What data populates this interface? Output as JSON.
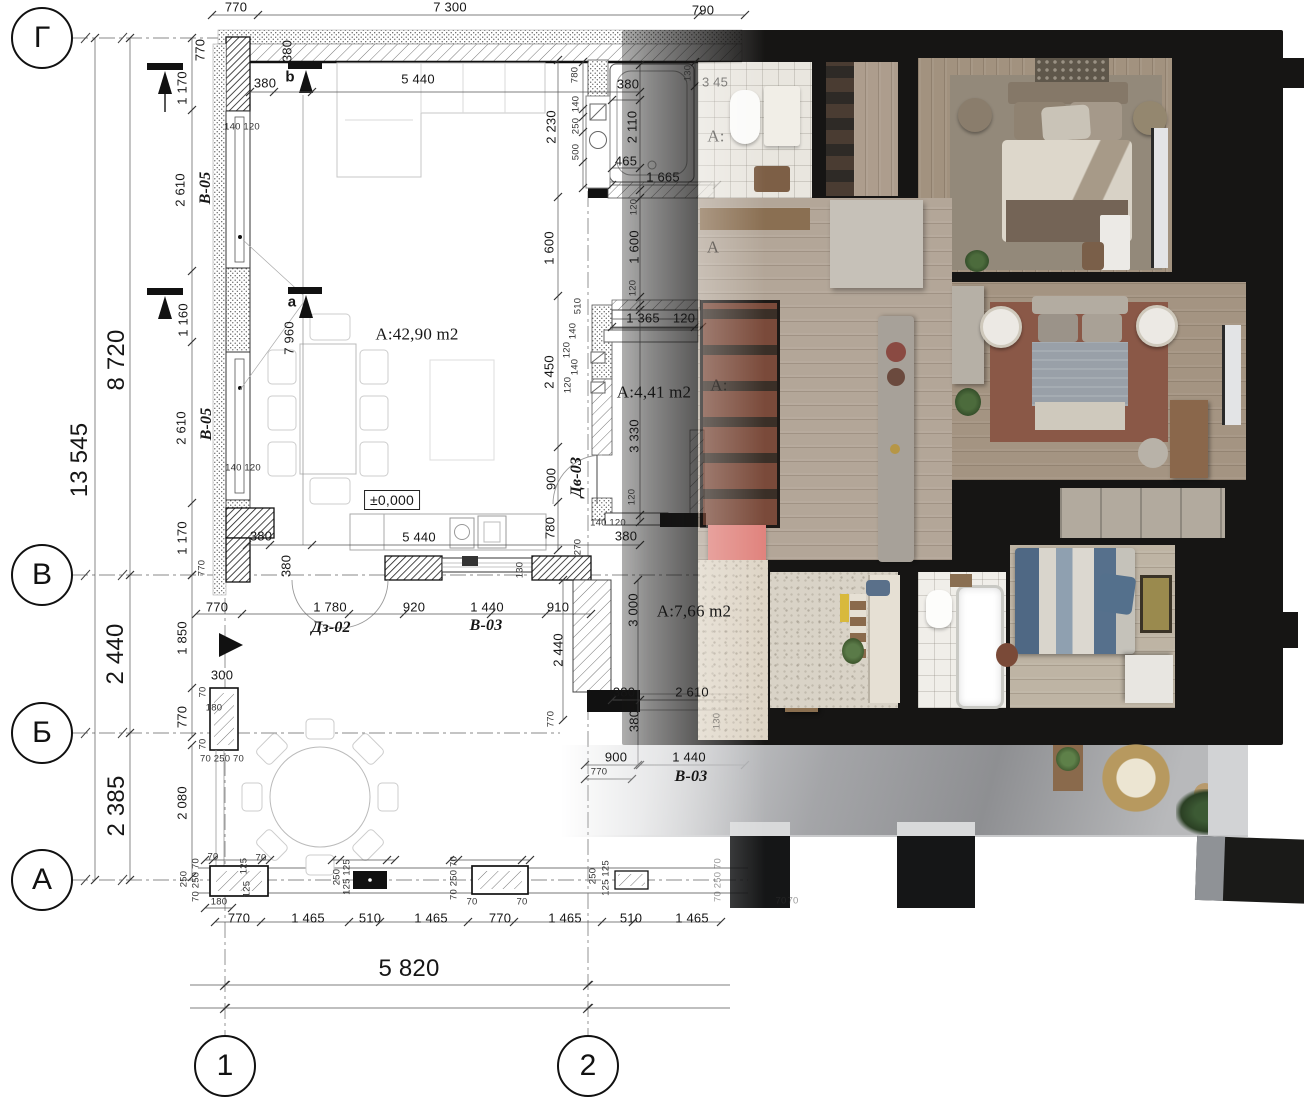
{
  "axes": {
    "row_bubbles": [
      "Г",
      "В",
      "Б",
      "А"
    ],
    "column_bubbles": [
      "1",
      "2"
    ]
  },
  "room_areas": [
    "A:42,90 m2",
    "А:4,41 m2",
    "A:7,66 m2"
  ],
  "level_mark": "±0,000",
  "window_tags": [
    "В-05",
    "В-03"
  ],
  "door_tags": [
    "Дз-02",
    "Дв-03"
  ],
  "overall_dimensions": {
    "left_total": "13 545",
    "left_upper": "8 720",
    "top_total": "7 300",
    "bottom_span": "5 820"
  },
  "colors": {
    "wall_render": "#161514",
    "wood_floor": "#ab9c8b",
    "rug_warm": "#8a5847",
    "rug_neutral": "#93897a",
    "bed_blue": "#54708c",
    "terrace_concrete": "#a4a5a8",
    "accent_bench": "#e0837d",
    "line_dark": "#1a1a1a"
  },
  "grid_bubbles": [
    {
      "t": "Г",
      "x": 42,
      "y": 38
    },
    {
      "t": "В",
      "x": 42,
      "y": 575
    },
    {
      "t": "Б",
      "x": 42,
      "y": 733
    },
    {
      "t": "А",
      "x": 42,
      "y": 880
    },
    {
      "t": "1",
      "x": 225,
      "y": 1066
    },
    {
      "t": "2",
      "x": 588,
      "y": 1066
    }
  ],
  "labels": [
    {
      "t": "770",
      "x": 236,
      "y": 7
    },
    {
      "t": "7 300",
      "x": 450,
      "y": 7
    },
    {
      "t": "790",
      "x": 703,
      "y": 10
    },
    {
      "t": "770",
      "x": 200,
      "y": 50,
      "c": "v"
    },
    {
      "t": "380",
      "x": 287,
      "y": 51,
      "c": "v"
    },
    {
      "t": "380",
      "x": 265,
      "y": 83
    },
    {
      "t": "b",
      "x": 290,
      "y": 77,
      "c": "bold"
    },
    {
      "t": "5 440",
      "x": 418,
      "y": 79
    },
    {
      "t": "1 170",
      "x": 182,
      "y": 88,
      "c": "v"
    },
    {
      "t": "140 120",
      "x": 242,
      "y": 127,
      "c": "s"
    },
    {
      "t": "2 610",
      "x": 180,
      "y": 190,
      "c": "v"
    },
    {
      "t": "В-05",
      "x": 206,
      "y": 188,
      "c": "v bi"
    },
    {
      "t": "1 160",
      "x": 183,
      "y": 320,
      "c": "v"
    },
    {
      "t": "2 610",
      "x": 181,
      "y": 428,
      "c": "v"
    },
    {
      "t": "В-05",
      "x": 207,
      "y": 424,
      "c": "v bi"
    },
    {
      "t": "140 120",
      "x": 243,
      "y": 468,
      "c": "s"
    },
    {
      "t": "1 170",
      "x": 182,
      "y": 538,
      "c": "v"
    },
    {
      "t": "770",
      "x": 202,
      "y": 568,
      "c": "v s"
    },
    {
      "t": "8 720",
      "x": 117,
      "y": 360,
      "c": "v big"
    },
    {
      "t": "13 545",
      "x": 80,
      "y": 460,
      "c": "v big"
    },
    {
      "t": "a",
      "x": 292,
      "y": 302,
      "c": "bold"
    },
    {
      "t": "7 960",
      "x": 289,
      "y": 338,
      "c": "v"
    },
    {
      "t": "A:42,90 m2",
      "x": 417,
      "y": 334,
      "c": "area"
    },
    {
      "t": "±0,000",
      "x": 392,
      "y": 500,
      "c": "boxed"
    },
    {
      "t": "5 440",
      "x": 419,
      "y": 537
    },
    {
      "t": "380",
      "x": 261,
      "y": 536
    },
    {
      "t": "380",
      "x": 286,
      "y": 566,
      "c": "v"
    },
    {
      "t": "770",
      "x": 217,
      "y": 607
    },
    {
      "t": "1 780",
      "x": 330,
      "y": 607
    },
    {
      "t": "920",
      "x": 414,
      "y": 607
    },
    {
      "t": "1 440",
      "x": 487,
      "y": 607
    },
    {
      "t": "910",
      "x": 558,
      "y": 607
    },
    {
      "t": "Дз-02",
      "x": 331,
      "y": 628,
      "c": "bi"
    },
    {
      "t": "В-03",
      "x": 486,
      "y": 626,
      "c": "bi"
    },
    {
      "t": "1 850",
      "x": 182,
      "y": 638,
      "c": "v"
    },
    {
      "t": "300",
      "x": 222,
      "y": 675
    },
    {
      "t": "180",
      "x": 214,
      "y": 708,
      "c": "s"
    },
    {
      "t": "770",
      "x": 182,
      "y": 717,
      "c": "v"
    },
    {
      "t": "70",
      "x": 203,
      "y": 692,
      "c": "v s"
    },
    {
      "t": "70",
      "x": 203,
      "y": 744,
      "c": "v s"
    },
    {
      "t": "70 250 70",
      "x": 222,
      "y": 759,
      "c": "s"
    },
    {
      "t": "2 440",
      "x": 116,
      "y": 654,
      "c": "v big"
    },
    {
      "t": "2 385",
      "x": 117,
      "y": 806,
      "c": "v big"
    },
    {
      "t": "2 080",
      "x": 182,
      "y": 803,
      "c": "v"
    },
    {
      "t": "250",
      "x": 184,
      "y": 879,
      "c": "v s"
    },
    {
      "t": "70 250 70",
      "x": 196,
      "y": 880,
      "c": "v s"
    },
    {
      "t": "70",
      "x": 213,
      "y": 857,
      "c": "s"
    },
    {
      "t": "70",
      "x": 261,
      "y": 858,
      "c": "s"
    },
    {
      "t": "125",
      "x": 244,
      "y": 866,
      "c": "v s"
    },
    {
      "t": "125",
      "x": 247,
      "y": 889,
      "c": "v s"
    },
    {
      "t": "180",
      "x": 219,
      "y": 902,
      "c": "s"
    },
    {
      "t": "770",
      "x": 239,
      "y": 918
    },
    {
      "t": "1 465",
      "x": 308,
      "y": 918
    },
    {
      "t": "510",
      "x": 370,
      "y": 918
    },
    {
      "t": "1 465",
      "x": 431,
      "y": 918
    },
    {
      "t": "770",
      "x": 500,
      "y": 918
    },
    {
      "t": "1 465",
      "x": 565,
      "y": 918
    },
    {
      "t": "510",
      "x": 631,
      "y": 918
    },
    {
      "t": "1 465",
      "x": 692,
      "y": 918
    },
    {
      "t": "250",
      "x": 337,
      "y": 877,
      "c": "v s"
    },
    {
      "t": "125 125",
      "x": 347,
      "y": 877,
      "c": "v s"
    },
    {
      "t": "70 250 70",
      "x": 454,
      "y": 878,
      "c": "v s"
    },
    {
      "t": "70",
      "x": 472,
      "y": 902,
      "c": "s"
    },
    {
      "t": "70",
      "x": 522,
      "y": 902,
      "c": "s"
    },
    {
      "t": "250",
      "x": 593,
      "y": 876,
      "c": "v s"
    },
    {
      "t": "125 125",
      "x": 606,
      "y": 878,
      "c": "v s"
    },
    {
      "t": "70 250 70",
      "x": 718,
      "y": 880,
      "c": "v s fade"
    },
    {
      "t": "70",
      "x": 781,
      "y": 901,
      "c": "s fade"
    },
    {
      "t": "70",
      "x": 793,
      "y": 901,
      "c": "s fade"
    },
    {
      "t": "5 820",
      "x": 409,
      "y": 969,
      "c": "big"
    },
    {
      "t": "780",
      "x": 575,
      "y": 75,
      "c": "v s"
    },
    {
      "t": "140",
      "x": 576,
      "y": 104,
      "c": "v s"
    },
    {
      "t": "250",
      "x": 576,
      "y": 126,
      "c": "v s"
    },
    {
      "t": "500",
      "x": 576,
      "y": 152,
      "c": "v s"
    },
    {
      "t": "2 230",
      "x": 551,
      "y": 127,
      "c": "v"
    },
    {
      "t": "2 110",
      "x": 632,
      "y": 127,
      "c": "v"
    },
    {
      "t": "380",
      "x": 628,
      "y": 84
    },
    {
      "t": "130",
      "x": 688,
      "y": 73,
      "c": "v s"
    },
    {
      "t": "3 45",
      "x": 715,
      "y": 82,
      "c": "fade"
    },
    {
      "t": "465",
      "x": 626,
      "y": 161
    },
    {
      "t": "1 665",
      "x": 663,
      "y": 177
    },
    {
      "t": "120",
      "x": 634,
      "y": 207,
      "c": "v s"
    },
    {
      "t": "1 600",
      "x": 549,
      "y": 248,
      "c": "v"
    },
    {
      "t": "1 600",
      "x": 634,
      "y": 247,
      "c": "v"
    },
    {
      "t": "120",
      "x": 633,
      "y": 288,
      "c": "v s"
    },
    {
      "t": "510",
      "x": 578,
      "y": 306,
      "c": "v s"
    },
    {
      "t": "140",
      "x": 573,
      "y": 331,
      "c": "v s"
    },
    {
      "t": "120",
      "x": 567,
      "y": 350,
      "c": "v s"
    },
    {
      "t": "140",
      "x": 575,
      "y": 367,
      "c": "v s"
    },
    {
      "t": "120",
      "x": 568,
      "y": 385,
      "c": "v s"
    },
    {
      "t": "1 365",
      "x": 643,
      "y": 318
    },
    {
      "t": "120",
      "x": 684,
      "y": 318
    },
    {
      "t": "А:4,41 m2",
      "x": 654,
      "y": 392,
      "c": "area"
    },
    {
      "t": "3 330",
      "x": 634,
      "y": 436,
      "c": "v"
    },
    {
      "t": "120",
      "x": 632,
      "y": 497,
      "c": "v s"
    },
    {
      "t": "Дв-03",
      "x": 577,
      "y": 477,
      "c": "v bi"
    },
    {
      "t": "900",
      "x": 551,
      "y": 479,
      "c": "v"
    },
    {
      "t": "780",
      "x": 550,
      "y": 528,
      "c": "v"
    },
    {
      "t": "2 450",
      "x": 549,
      "y": 372,
      "c": "v"
    },
    {
      "t": "140 120",
      "x": 608,
      "y": 523,
      "c": "s"
    },
    {
      "t": "270",
      "x": 578,
      "y": 547,
      "c": "v s"
    },
    {
      "t": "380",
      "x": 626,
      "y": 536
    },
    {
      "t": "130",
      "x": 520,
      "y": 570,
      "c": "v s"
    },
    {
      "t": "2 440",
      "x": 558,
      "y": 650,
      "c": "v"
    },
    {
      "t": "3 000",
      "x": 633,
      "y": 610,
      "c": "v"
    },
    {
      "t": "A:7,66 m2",
      "x": 694,
      "y": 611,
      "c": "area"
    },
    {
      "t": "380",
      "x": 624,
      "y": 692
    },
    {
      "t": "2 610",
      "x": 692,
      "y": 692
    },
    {
      "t": "380",
      "x": 634,
      "y": 721,
      "c": "v"
    },
    {
      "t": "770",
      "x": 551,
      "y": 719,
      "c": "v s"
    },
    {
      "t": "130",
      "x": 717,
      "y": 721,
      "c": "v s fade"
    },
    {
      "t": "900",
      "x": 616,
      "y": 757
    },
    {
      "t": "1 440",
      "x": 689,
      "y": 757
    },
    {
      "t": "В-03",
      "x": 691,
      "y": 777,
      "c": "bi"
    },
    {
      "t": "770",
      "x": 599,
      "y": 772,
      "c": "s"
    },
    {
      "t": "А:",
      "x": 716,
      "y": 136,
      "c": "area fade"
    },
    {
      "t": "A",
      "x": 713,
      "y": 247,
      "c": "area fade"
    },
    {
      "t": "А:",
      "x": 719,
      "y": 385,
      "c": "area fade"
    }
  ]
}
